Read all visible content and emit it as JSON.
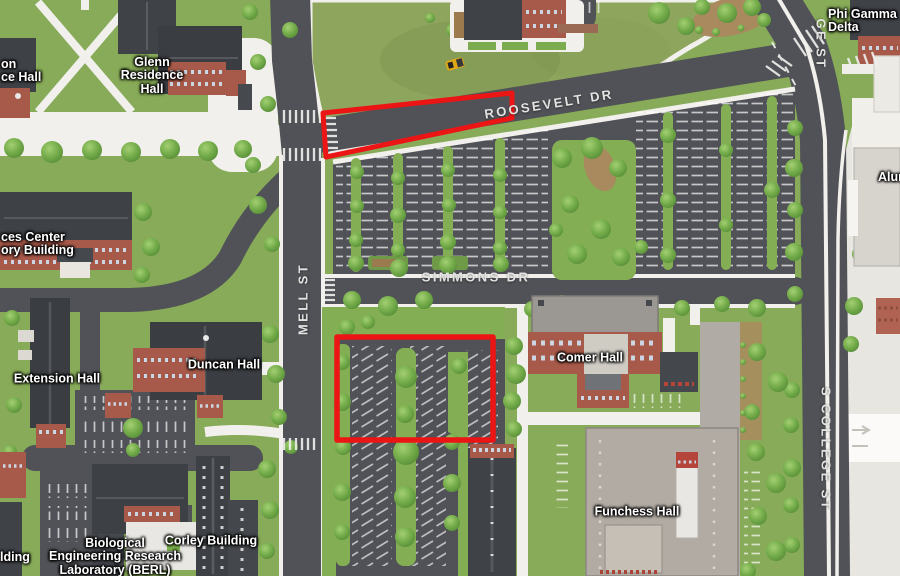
{
  "map": {
    "title": "campus map with highlighted parking areas",
    "colors": {
      "highlight": "#ec1515",
      "grass": "#87ab58",
      "field": "#8da55c",
      "road": "#515257",
      "path": "#f2f0ec",
      "brick": "#a85a4a",
      "roof_dark": "#3f4247",
      "off_campus": "#e8e6e1"
    },
    "building_labels": [
      {
        "id": "glenn",
        "text": "Glenn\nResidence\nHall"
      },
      {
        "id": "hall-topleft-partial",
        "text": "on\nce Hall"
      },
      {
        "id": "sciences-center-partial",
        "text": "ces Center\nory Building"
      },
      {
        "id": "extension",
        "text": "Extension Hall"
      },
      {
        "id": "duncan",
        "text": "Duncan Hall"
      },
      {
        "id": "comer",
        "text": "Comer Hall"
      },
      {
        "id": "funchess",
        "text": "Funchess Hall"
      },
      {
        "id": "corley",
        "text": "Corley Building"
      },
      {
        "id": "berl",
        "text": "Biological\nEngineering Research\nLaboratory (BERL)"
      },
      {
        "id": "phi-gamma-delta",
        "text": "Phi Gamma Delta"
      },
      {
        "id": "alumni-partial",
        "text": "Alum"
      },
      {
        "id": "building-bottom-partial",
        "text": "lding"
      }
    ],
    "road_labels": [
      {
        "id": "roosevelt-dr",
        "text": "ROOSEVELT DR"
      },
      {
        "id": "simmons-dr",
        "text": "SIMMONS DR"
      },
      {
        "id": "mell-st",
        "text": "MELL ST"
      },
      {
        "id": "s-college-st",
        "text": "S COLLEGE ST"
      },
      {
        "id": "college-st-top-partial",
        "text": "GE ST"
      }
    ],
    "highlights": [
      {
        "id": "roosevelt-strip",
        "shape": "polygon"
      },
      {
        "id": "parking-lot-rect",
        "shape": "rectangle"
      }
    ]
  }
}
